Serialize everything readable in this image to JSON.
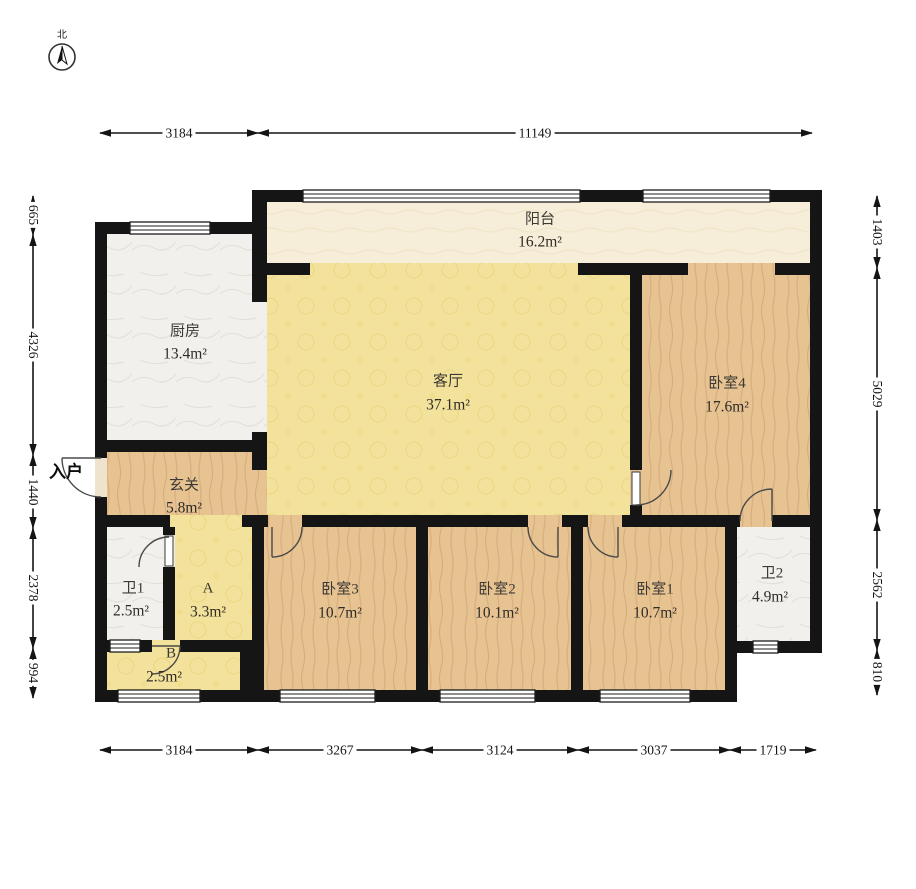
{
  "compass": {
    "north_label": "北"
  },
  "entrance": {
    "label": "入户"
  },
  "rooms": {
    "balcony": {
      "name": "阳台",
      "area": "16.2m²"
    },
    "kitchen": {
      "name": "厨房",
      "area": "13.4m²"
    },
    "living": {
      "name": "客厅",
      "area": "37.1m²"
    },
    "bedroom4": {
      "name": "卧室4",
      "area": "17.6m²"
    },
    "hall": {
      "name": "玄关",
      "area": "5.8m²"
    },
    "bath1": {
      "name": "卫1",
      "area": "2.5m²"
    },
    "storageA": {
      "name": "A",
      "area": "3.3m²"
    },
    "storageB": {
      "name": "B",
      "area": "2.5m²"
    },
    "bedroom3": {
      "name": "卧室3",
      "area": "10.7m²"
    },
    "bedroom2": {
      "name": "卧室2",
      "area": "10.1m²"
    },
    "bedroom1": {
      "name": "卧室1",
      "area": "10.7m²"
    },
    "bath2": {
      "name": "卫2",
      "area": "4.9m²"
    }
  },
  "dimensions": {
    "top": [
      "3184",
      "11149"
    ],
    "bottom": [
      "3184",
      "3267",
      "3124",
      "3037",
      "1719"
    ],
    "left": [
      "665",
      "4326",
      "1440",
      "2378",
      "994"
    ],
    "right": [
      "1403",
      "5029",
      "2562",
      "810"
    ]
  },
  "colors": {
    "wall": "#151515",
    "dimension_line": "#141414",
    "wood_floor": "#e7c392",
    "yellow_floor": "#f3e29b",
    "balcony_floor": "#f6eed8",
    "tile_floor": "#f2f0ec"
  }
}
